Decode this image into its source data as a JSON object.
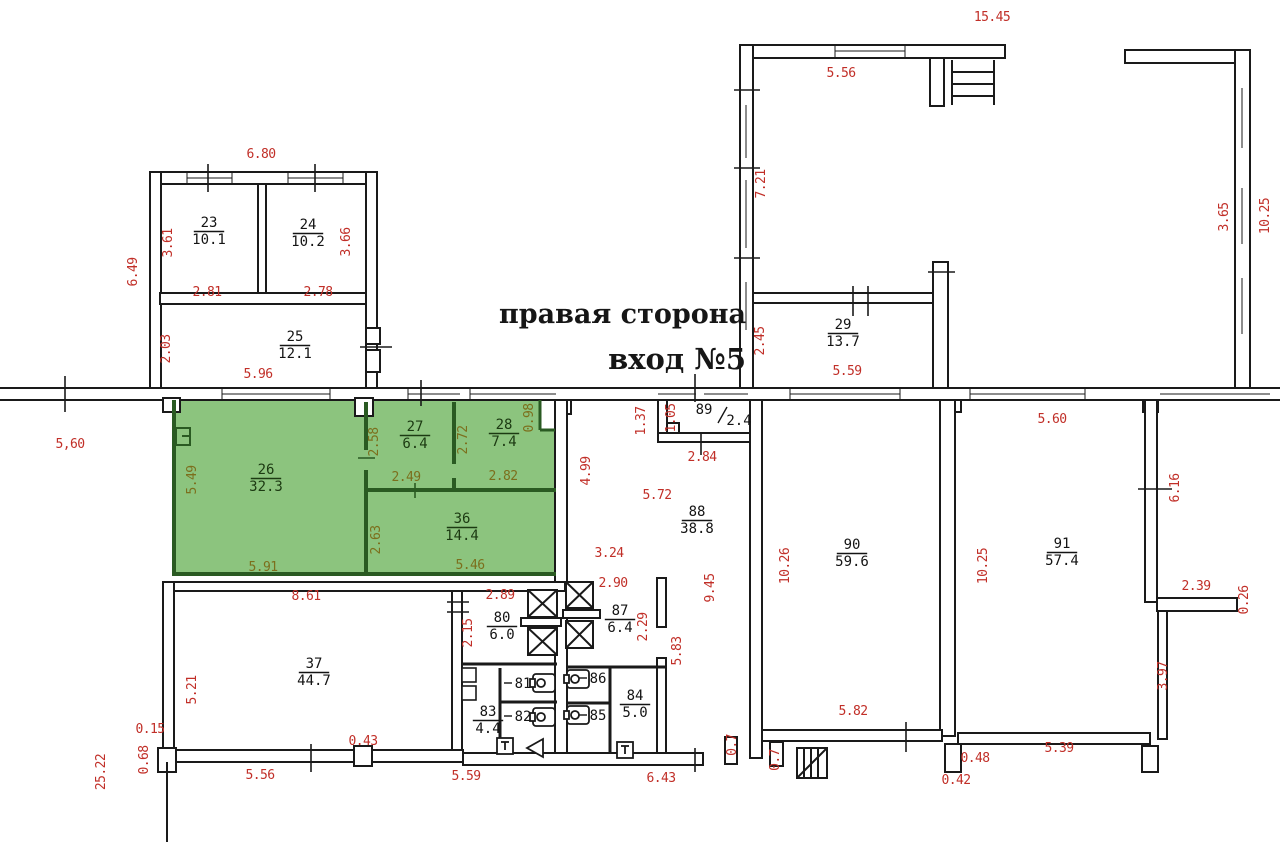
{
  "title": {
    "line1": "правая сторона",
    "line2": "вход №5"
  },
  "colors": {
    "dimension_red": "#c12f28",
    "dimension_olive": "#7c6f1d",
    "highlight_green": "#8cc47e",
    "wall_black": "#1a1a1a",
    "green_wall": "#2a5a22"
  },
  "icons": {
    "elevator": "elevator-shaft-icon",
    "toilet": "toilet-icon",
    "stairs": "stairs-icon",
    "door": "door-icon"
  },
  "rooms": [
    {
      "num": "23",
      "area": "10.1",
      "x": 209,
      "y": 227
    },
    {
      "num": "24",
      "area": "10.2",
      "x": 308,
      "y": 229
    },
    {
      "num": "25",
      "area": "12.1",
      "x": 295,
      "y": 341
    },
    {
      "num": "26",
      "area": "32.3",
      "x": 266,
      "y": 474,
      "g": true
    },
    {
      "num": "27",
      "area": "6.4",
      "x": 415,
      "y": 431,
      "g": true
    },
    {
      "num": "28",
      "area": "7.4",
      "x": 504,
      "y": 429,
      "g": true
    },
    {
      "num": "36",
      "area": "14.4",
      "x": 462,
      "y": 523,
      "g": true
    },
    {
      "num": "29",
      "area": "13.7",
      "x": 843,
      "y": 329
    },
    {
      "num": "37",
      "area": "44.7",
      "x": 314,
      "y": 668
    },
    {
      "num": "80",
      "area": "6.0",
      "x": 502,
      "y": 622
    },
    {
      "num": "87",
      "area": "6.4",
      "x": 620,
      "y": 615
    },
    {
      "num": "83",
      "area": "4.4",
      "x": 488,
      "y": 716
    },
    {
      "num": "84",
      "area": "5.0",
      "x": 635,
      "y": 700
    },
    {
      "num": "88",
      "area": "38.8",
      "x": 697,
      "y": 516
    },
    {
      "num": "89",
      "area": "2.4",
      "x": 704,
      "y": 414,
      "slash": true
    },
    {
      "num": "90",
      "area": "59.6",
      "x": 852,
      "y": 549
    },
    {
      "num": "91",
      "area": "57.4",
      "x": 1062,
      "y": 548
    },
    {
      "num": "81",
      "x": 523,
      "y": 688
    },
    {
      "num": "82",
      "x": 523,
      "y": 721
    },
    {
      "num": "85",
      "x": 598,
      "y": 720
    },
    {
      "num": "86",
      "x": 598,
      "y": 683
    }
  ],
  "dims": [
    {
      "t": "6.80",
      "x": 261,
      "y": 158
    },
    {
      "t": "6.49",
      "x": 137,
      "y": 272,
      "r": true
    },
    {
      "t": "3.61",
      "x": 172,
      "y": 243,
      "r": true
    },
    {
      "t": "3.66",
      "x": 350,
      "y": 242,
      "r": true
    },
    {
      "t": "2.81",
      "x": 207,
      "y": 296
    },
    {
      "t": "2.78",
      "x": 318,
      "y": 296
    },
    {
      "t": "2.03",
      "x": 170,
      "y": 349,
      "r": true
    },
    {
      "t": "5.96",
      "x": 258,
      "y": 378
    },
    {
      "t": "5,60",
      "x": 70,
      "y": 448
    },
    {
      "t": "5.49",
      "x": 196,
      "y": 480,
      "r": true,
      "g": true
    },
    {
      "t": "2.58",
      "x": 378,
      "y": 442,
      "r": true,
      "g": true
    },
    {
      "t": "2.49",
      "x": 406,
      "y": 481,
      "g": true
    },
    {
      "t": "2.72",
      "x": 467,
      "y": 440,
      "r": true,
      "g": true
    },
    {
      "t": "2.82",
      "x": 503,
      "y": 480,
      "g": true
    },
    {
      "t": "0.98",
      "x": 533,
      "y": 418,
      "r": true,
      "g": true
    },
    {
      "t": "2.63",
      "x": 380,
      "y": 540,
      "r": true,
      "g": true
    },
    {
      "t": "5.91",
      "x": 263,
      "y": 571,
      "g": true
    },
    {
      "t": "5.46",
      "x": 470,
      "y": 569,
      "g": true
    },
    {
      "t": "1.37",
      "x": 645,
      "y": 421,
      "r": true
    },
    {
      "t": "1.05",
      "x": 675,
      "y": 418,
      "r": true
    },
    {
      "t": "2.84",
      "x": 702,
      "y": 461
    },
    {
      "t": "2.45",
      "x": 764,
      "y": 341,
      "r": true
    },
    {
      "t": "5.59",
      "x": 847,
      "y": 375
    },
    {
      "t": "15.45",
      "x": 992,
      "y": 21
    },
    {
      "t": "5.56",
      "x": 841,
      "y": 77
    },
    {
      "t": "7.21",
      "x": 765,
      "y": 184,
      "r": true
    },
    {
      "t": "10.25",
      "x": 1269,
      "y": 216,
      "r": true
    },
    {
      "t": "3.65",
      "x": 1228,
      "y": 217,
      "r": true
    },
    {
      "t": "4.99",
      "x": 590,
      "y": 471,
      "r": true
    },
    {
      "t": "5.72",
      "x": 657,
      "y": 499
    },
    {
      "t": "3.24",
      "x": 609,
      "y": 557
    },
    {
      "t": "9.45",
      "x": 714,
      "y": 588,
      "r": true
    },
    {
      "t": "2.90",
      "x": 613,
      "y": 587
    },
    {
      "t": "2.29",
      "x": 647,
      "y": 627,
      "r": true
    },
    {
      "t": "5.83",
      "x": 681,
      "y": 651,
      "r": true
    },
    {
      "t": "2.89",
      "x": 500,
      "y": 599
    },
    {
      "t": "2.15",
      "x": 472,
      "y": 633,
      "r": true
    },
    {
      "t": "8.61",
      "x": 306,
      "y": 600
    },
    {
      "t": "5.21",
      "x": 196,
      "y": 690,
      "r": true
    },
    {
      "t": "0.15",
      "x": 150,
      "y": 733
    },
    {
      "t": "0.68",
      "x": 148,
      "y": 760,
      "r": true
    },
    {
      "t": "25.22",
      "x": 105,
      "y": 772,
      "r": true
    },
    {
      "t": "5.56",
      "x": 260,
      "y": 779
    },
    {
      "t": "0.43",
      "x": 363,
      "y": 745
    },
    {
      "t": "5.59",
      "x": 466,
      "y": 780
    },
    {
      "t": "6.43",
      "x": 661,
      "y": 782
    },
    {
      "t": "0.7",
      "x": 736,
      "y": 745,
      "r": true
    },
    {
      "t": "0.7",
      "x": 779,
      "y": 760,
      "r": true
    },
    {
      "t": "10.26",
      "x": 789,
      "y": 566,
      "r": true
    },
    {
      "t": "5.82",
      "x": 853,
      "y": 715
    },
    {
      "t": "10.25",
      "x": 987,
      "y": 566,
      "r": true
    },
    {
      "t": "5.60",
      "x": 1052,
      "y": 423
    },
    {
      "t": "5.39",
      "x": 1059,
      "y": 752
    },
    {
      "t": "0.48",
      "x": 975,
      "y": 762
    },
    {
      "t": "0.42",
      "x": 956,
      "y": 784
    },
    {
      "t": "6.16",
      "x": 1179,
      "y": 488,
      "r": true
    },
    {
      "t": "2.39",
      "x": 1196,
      "y": 590
    },
    {
      "t": "0.26",
      "x": 1248,
      "y": 600,
      "r": true
    },
    {
      "t": "3.97",
      "x": 1167,
      "y": 676,
      "r": true
    }
  ]
}
